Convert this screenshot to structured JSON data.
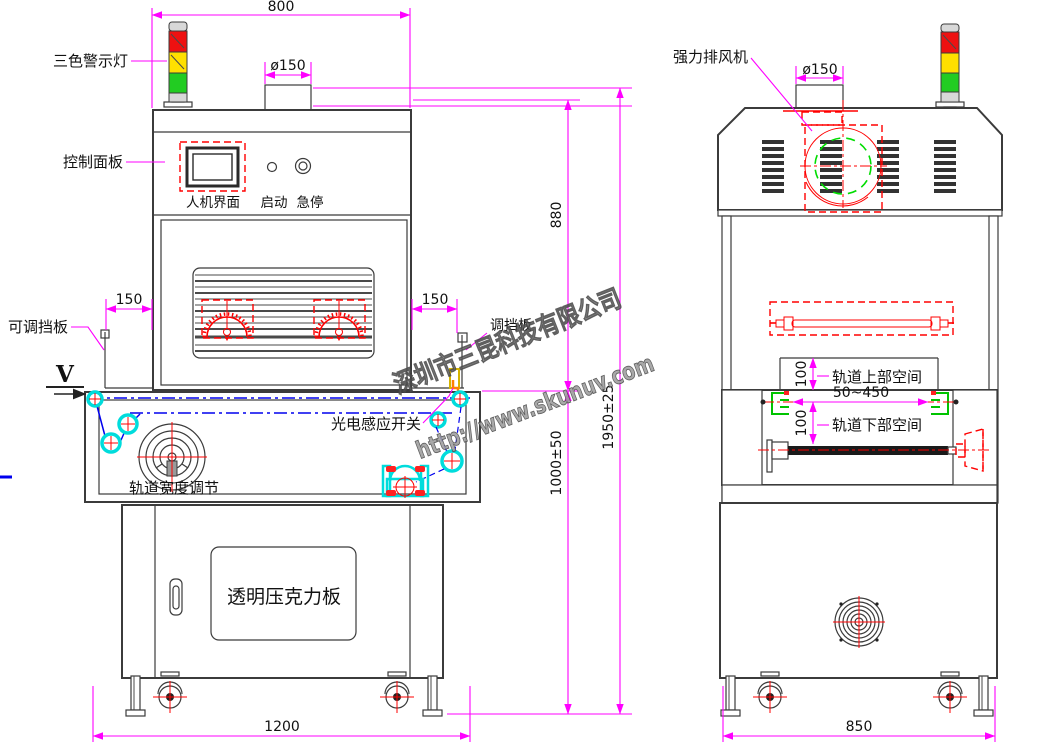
{
  "watermark": {
    "company": "深圳市三昆科技有限公司",
    "url": "http://www.skunuv.com"
  },
  "front_view": {
    "labels": {
      "warning_light": "三色警示灯",
      "control_panel": "控制面板",
      "hmi": "人机界面",
      "start_btn": "启动",
      "estop_btn": "急停",
      "adj_baffle": "可调挡板",
      "view_v": "V",
      "baffle_right": "调挡板",
      "photo_sensor": "光电感应开关",
      "track_width": "轨道宽度调节",
      "acrylic": "透明压克力板"
    },
    "dims": {
      "width800": "800",
      "dia150": "ø150",
      "gap150_l": "150",
      "gap150_r": "150",
      "h880": "880",
      "h1950": "1950±25",
      "h1000": "1000±50",
      "w1200": "1200"
    }
  },
  "side_view": {
    "labels": {
      "exhaust_fan": "强力排风机",
      "upper_space": "轨道上部空间",
      "lower_space": "轨道下部空间"
    },
    "dims": {
      "dia150": "ø150",
      "d100_u": "100",
      "d100_l": "100",
      "range": "50~450",
      "w850": "850"
    }
  },
  "colors": {
    "dimension": "#ff00ff",
    "detail_red": "#ff0000",
    "belt_blue": "#0000ee",
    "pulley_cyan": "#00dcdc",
    "rail_green": "#00c400",
    "light_red": "#ee1111",
    "light_yellow": "#ffe000",
    "light_green": "#22cc22",
    "watermark_gray": "#9e9e9e"
  }
}
